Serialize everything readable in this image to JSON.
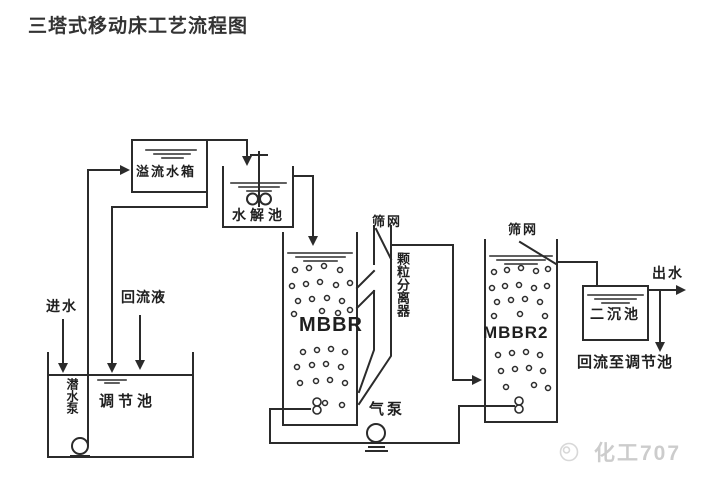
{
  "page": {
    "title": "三塔式移动床工艺流程图"
  },
  "diagram": {
    "line_color": "#2b2b2b",
    "labels": {
      "overflow_tank": "溢流水箱",
      "hydrolysis_tank": "水解池",
      "mbbr1": "MBBR",
      "mbbr2": "MBBR2",
      "screen1": "筛网",
      "screen2": "筛网",
      "particle_separator": "颗粒分离器",
      "secondary_sedimentation_tank": "二沉池",
      "regulating_tank": "调节池",
      "submersible_pump": "潜水泵",
      "air_pump": "气泵",
      "influent": "进水",
      "return_liquid": "回流液",
      "effluent": "出水",
      "return_to_regulating_tank": "回流至调节池"
    }
  },
  "watermark": {
    "text": "化工707",
    "color": "#cccccc"
  }
}
